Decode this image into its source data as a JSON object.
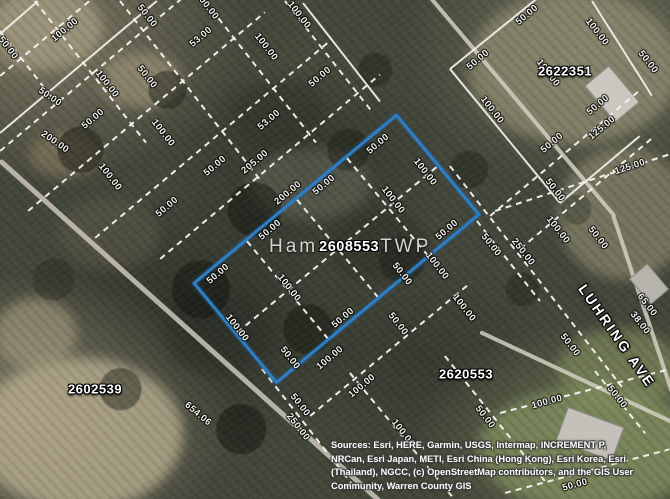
{
  "map": {
    "township": {
      "prefix": "Ham",
      "suffix": "TWP"
    },
    "selected_parcel": {
      "id": "2608553",
      "highlight_color": "#2d7ec4"
    },
    "parcel_labels": [
      {
        "id": "2622351",
        "x": 565,
        "y": 71
      },
      {
        "id": "2602539",
        "x": 95,
        "y": 389
      },
      {
        "id": "2620553",
        "x": 466,
        "y": 374
      }
    ],
    "street_label": {
      "text": "LUHRING AVE",
      "rotation": 55
    },
    "dimension_labels": [
      {
        "t": "100.00",
        "x": 65,
        "y": 30,
        "r": -40
      },
      {
        "t": "50.00",
        "x": 147,
        "y": 16,
        "r": 52
      },
      {
        "t": "100.00",
        "x": 207,
        "y": 6,
        "r": 52
      },
      {
        "t": "100.00",
        "x": 299,
        "y": 15,
        "r": 52
      },
      {
        "t": "53.00",
        "x": 201,
        "y": 37,
        "r": -40
      },
      {
        "t": "100.00",
        "x": 266,
        "y": 47,
        "r": 52
      },
      {
        "t": "50.00",
        "x": 8,
        "y": 48,
        "r": 52
      },
      {
        "t": "50.00",
        "x": 320,
        "y": 77,
        "r": -40
      },
      {
        "t": "100.00",
        "x": 107,
        "y": 84,
        "r": 52
      },
      {
        "t": "50.00",
        "x": 147,
        "y": 77,
        "r": 52
      },
      {
        "t": "50.00",
        "x": 50,
        "y": 97,
        "r": 35
      },
      {
        "t": "50.00",
        "x": 93,
        "y": 119,
        "r": -40
      },
      {
        "t": "100.00",
        "x": 163,
        "y": 133,
        "r": 52
      },
      {
        "t": "53.00",
        "x": 269,
        "y": 120,
        "r": -40
      },
      {
        "t": "200.00",
        "x": 55,
        "y": 142,
        "r": 35
      },
      {
        "t": "100.00",
        "x": 110,
        "y": 177,
        "r": 52
      },
      {
        "t": "50.00",
        "x": 167,
        "y": 207,
        "r": -40
      },
      {
        "t": "205.00",
        "x": 255,
        "y": 162,
        "r": -40
      },
      {
        "t": "50.00",
        "x": 215,
        "y": 166,
        "r": -40
      },
      {
        "t": "200.00",
        "x": 288,
        "y": 193,
        "r": -40
      },
      {
        "t": "50.00",
        "x": 324,
        "y": 185,
        "r": -40
      },
      {
        "t": "50.00",
        "x": 378,
        "y": 144,
        "r": -40
      },
      {
        "t": "50.00",
        "x": 270,
        "y": 230,
        "r": -40
      },
      {
        "t": "50.00",
        "x": 218,
        "y": 274,
        "r": -40
      },
      {
        "t": "100.00",
        "x": 425,
        "y": 172,
        "r": 52
      },
      {
        "t": "100.00",
        "x": 393,
        "y": 200,
        "r": 52
      },
      {
        "t": "100.00",
        "x": 237,
        "y": 328,
        "r": 52
      },
      {
        "t": "100.00",
        "x": 289,
        "y": 288,
        "r": 52
      },
      {
        "t": "50.00",
        "x": 343,
        "y": 318,
        "r": -40
      },
      {
        "t": "50.00",
        "x": 398,
        "y": 324,
        "r": 52
      },
      {
        "t": "50.00",
        "x": 447,
        "y": 230,
        "r": -40
      },
      {
        "t": "100.00",
        "x": 437,
        "y": 266,
        "r": 52
      },
      {
        "t": "50.00",
        "x": 402,
        "y": 274,
        "r": 52
      },
      {
        "t": "100.00",
        "x": 464,
        "y": 308,
        "r": 52
      },
      {
        "t": "50.00",
        "x": 290,
        "y": 358,
        "r": 52
      },
      {
        "t": "100.00",
        "x": 330,
        "y": 358,
        "r": -40
      },
      {
        "t": "100.00",
        "x": 362,
        "y": 386,
        "r": -40
      },
      {
        "t": "50.00",
        "x": 491,
        "y": 245,
        "r": 52
      },
      {
        "t": "50.00",
        "x": 527,
        "y": 15,
        "r": -40
      },
      {
        "t": "100.00",
        "x": 597,
        "y": 32,
        "r": 52
      },
      {
        "t": "50.00",
        "x": 478,
        "y": 60,
        "r": -40
      },
      {
        "t": "100.00",
        "x": 548,
        "y": 73,
        "r": 52
      },
      {
        "t": "50.00",
        "x": 648,
        "y": 62,
        "r": 52
      },
      {
        "t": "50.00",
        "x": 598,
        "y": 105,
        "r": -40
      },
      {
        "t": "125.00",
        "x": 602,
        "y": 128,
        "r": -40
      },
      {
        "t": "50.00",
        "x": 552,
        "y": 143,
        "r": -40
      },
      {
        "t": "125.00",
        "x": 630,
        "y": 167,
        "r": -18
      },
      {
        "t": "50.00",
        "x": 555,
        "y": 190,
        "r": 52
      },
      {
        "t": "100.00",
        "x": 558,
        "y": 230,
        "r": 52
      },
      {
        "t": "50.00",
        "x": 598,
        "y": 238,
        "r": 52
      },
      {
        "t": "250.00",
        "x": 523,
        "y": 252,
        "r": 52
      },
      {
        "t": "100.00",
        "x": 492,
        "y": 110,
        "r": 52
      },
      {
        "t": "65.00",
        "x": 647,
        "y": 305,
        "r": 52
      },
      {
        "t": "38.00",
        "x": 640,
        "y": 323,
        "r": 52
      },
      {
        "t": "50.00",
        "x": 570,
        "y": 345,
        "r": 52
      },
      {
        "t": "100.00",
        "x": 547,
        "y": 402,
        "r": -15
      },
      {
        "t": "50.00",
        "x": 617,
        "y": 397,
        "r": 52
      },
      {
        "t": "50.00",
        "x": 575,
        "y": 485,
        "r": -15
      },
      {
        "t": "50.00",
        "x": 485,
        "y": 417,
        "r": 52
      },
      {
        "t": "100.00",
        "x": 403,
        "y": 433,
        "r": 52
      },
      {
        "t": "250.00",
        "x": 298,
        "y": 427,
        "r": 52
      },
      {
        "t": "50.00",
        "x": 300,
        "y": 405,
        "r": 52
      },
      {
        "t": "654.06",
        "x": 198,
        "y": 414,
        "r": 40
      }
    ],
    "attribution": {
      "lines": [
        "Sources: Esri, HERE, Garmin, USGS, Intermap, INCREMENT P,",
        "NRCan, Esri Japan, METI, Esri China (Hong Kong), Esri Korea, Esri",
        "(Thailand), NGCC, (c) OpenStreetMap contributors, and the GIS User",
        "Community, Warren County GIS"
      ]
    },
    "colors": {
      "parcel_highlight": "#2d7ec4",
      "lot_line": "#f3f2ec",
      "road": "#d4cfc2",
      "label_text": "#ffffff",
      "township_text": "#d3d4d0"
    }
  }
}
